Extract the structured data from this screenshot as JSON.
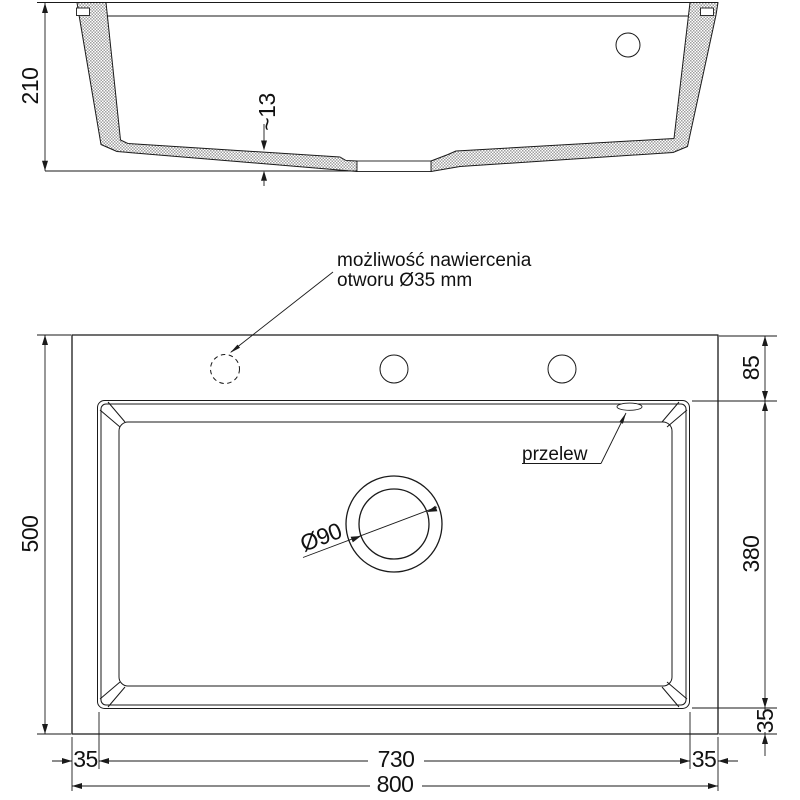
{
  "section_view": {
    "height_total": "210",
    "floor_thickness": "~13"
  },
  "plan_view": {
    "note_line1": "możliwość nawiercenia",
    "note_line2": "otworu Ø35 mm",
    "overflow_label": "przelew",
    "drain_diameter": "Ø90",
    "dim_height_total": "500",
    "dim_deck_top": "85",
    "dim_bowl_length": "380",
    "dim_bowl_bottom_margin": "35",
    "dim_left_margin": "35",
    "dim_bowl_width": "730",
    "dim_right_margin": "35",
    "dim_width_total": "800"
  }
}
